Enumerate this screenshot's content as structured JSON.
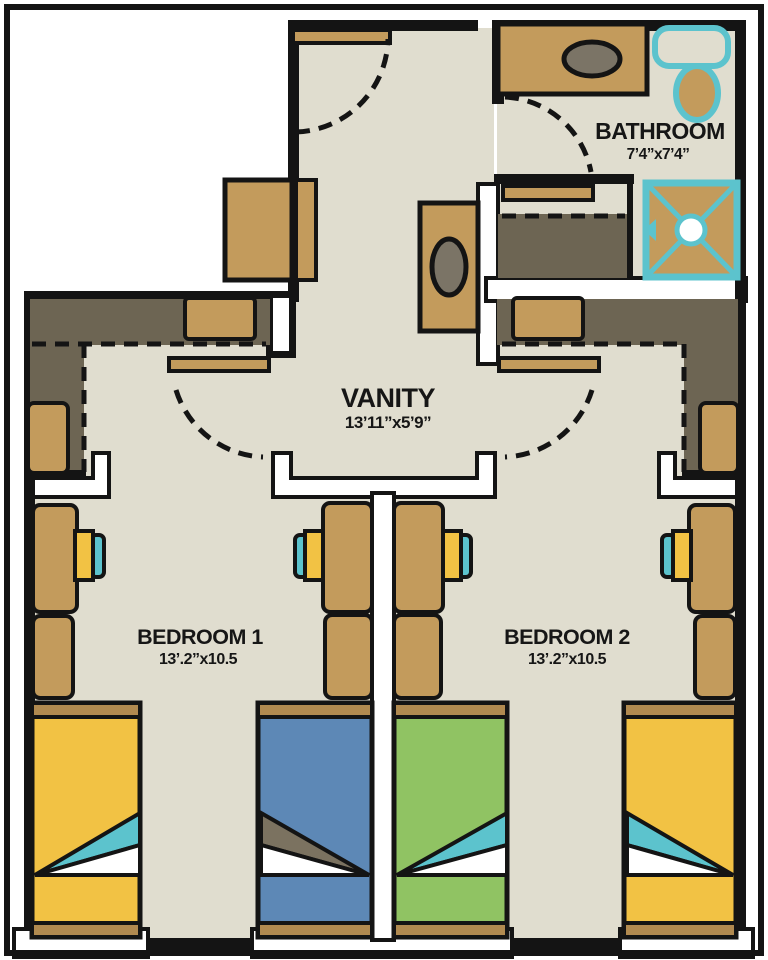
{
  "title": "Suite floor plan",
  "rooms": {
    "bathroom": {
      "label": "BATHROOM",
      "dims": "7’4”x7’4”"
    },
    "vanity": {
      "label": "VANITY",
      "dims": "13’11”x5’9”"
    },
    "bedroom1": {
      "label": "BEDROOM 1",
      "dims": "13’.2”x10.5"
    },
    "bedroom2": {
      "label": "BEDROOM 2",
      "dims": "13’.2”x10.5"
    }
  },
  "colors": {
    "wall": "#141414",
    "floor": "#e0ddcf",
    "outside": "#ffffff",
    "wood": "#c39b5c",
    "wood_dark": "#b18a50",
    "closet": "#6d6553",
    "teal": "#5cc3cd",
    "yellow": "#f2c244",
    "blue": "#5d88b6",
    "green": "#90c363",
    "olive": "#7b7260",
    "sink": "#7b7466",
    "ink": "#161616"
  }
}
